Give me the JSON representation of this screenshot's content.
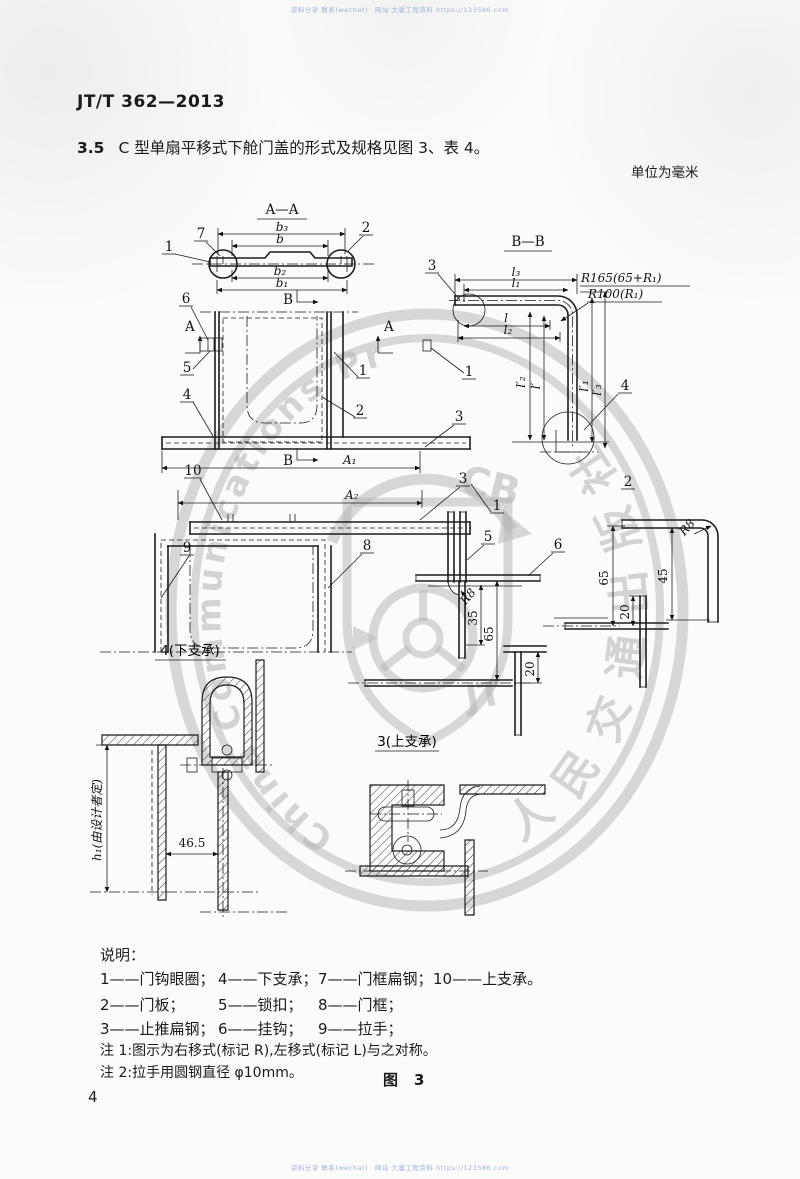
{
  "page": {
    "standard_no": "JT/T 362—2013",
    "clause_no": "3.5",
    "clause_text": "C 型单扇平移式下舱门盖的形式及规格见图 3、表 4。",
    "unit_note": "单位为毫米",
    "figure_label": "图",
    "figure_no": "3",
    "page_no": "4",
    "scan_line_top": "资料分享·联系(wechat)　网站·大量工程资料 https://123586.com",
    "scan_line_bottom": "资料分享·联系(wechat)　网站·大量工程资料 https://123586.com"
  },
  "legend": {
    "title": "说明：",
    "row1": [
      "1——门钩眼圈；",
      "4——下支承；",
      "7——门框扁钢；",
      "10——上支承。"
    ],
    "row2": [
      "2——门板；",
      "5——锁扣；",
      "8——门框；"
    ],
    "row3": [
      "3——止推扁钢；",
      "6——挂钩；",
      "9——拉手；"
    ],
    "note1": "注 1:图示为右移式(标记 R),左移式(标记 L)与之对称。",
    "note2": "注 2:拉手用圆钢直径 φ10mm。"
  },
  "drawing": {
    "aa": {
      "title": "A—A",
      "b3": "b₃",
      "b": "b",
      "b2": "b₂",
      "b1": "b₁",
      "p7": "7",
      "p1": "1",
      "p2": "2"
    },
    "bb": {
      "title": "B—B",
      "l3": "l₃",
      "l1": "l₁",
      "r165": "R165(65+R₁)",
      "r100": "R100(R₁)",
      "l": "l",
      "l2": "l₂",
      "lp2": "l′₂",
      "lp": "l′",
      "lp1": "l′₁",
      "lp3": "l′₃",
      "p3": "3",
      "p1": "1",
      "p4": "4"
    },
    "plan1": {
      "a": "A",
      "b": "B",
      "a1": "A₁",
      "p6": "6",
      "p5": "5",
      "p4": "4",
      "p1": "1",
      "p2": "2",
      "p3": "3",
      "p10": "10"
    },
    "plan2": {
      "a2": "A₂",
      "p9": "9",
      "p8": "8",
      "p3": "3"
    },
    "center": {
      "p1": "1",
      "p5": "5",
      "p6": "6",
      "r8": "R8",
      "d35": "35",
      "d65": "65",
      "d20": "20",
      "caption": "3(上支承)"
    },
    "right": {
      "p2": "2",
      "r8": "R8",
      "d45": "45",
      "d65": "65",
      "d20": "20"
    },
    "lower": {
      "caption": "4(下支承)",
      "d465": "46.5",
      "h1": "h₁(由设计者定)"
    }
  },
  "watermark": {
    "latin": "China Communications Press",
    "cjk": "人民交通出版社",
    "cb": "CB",
    "jt": "JT"
  }
}
